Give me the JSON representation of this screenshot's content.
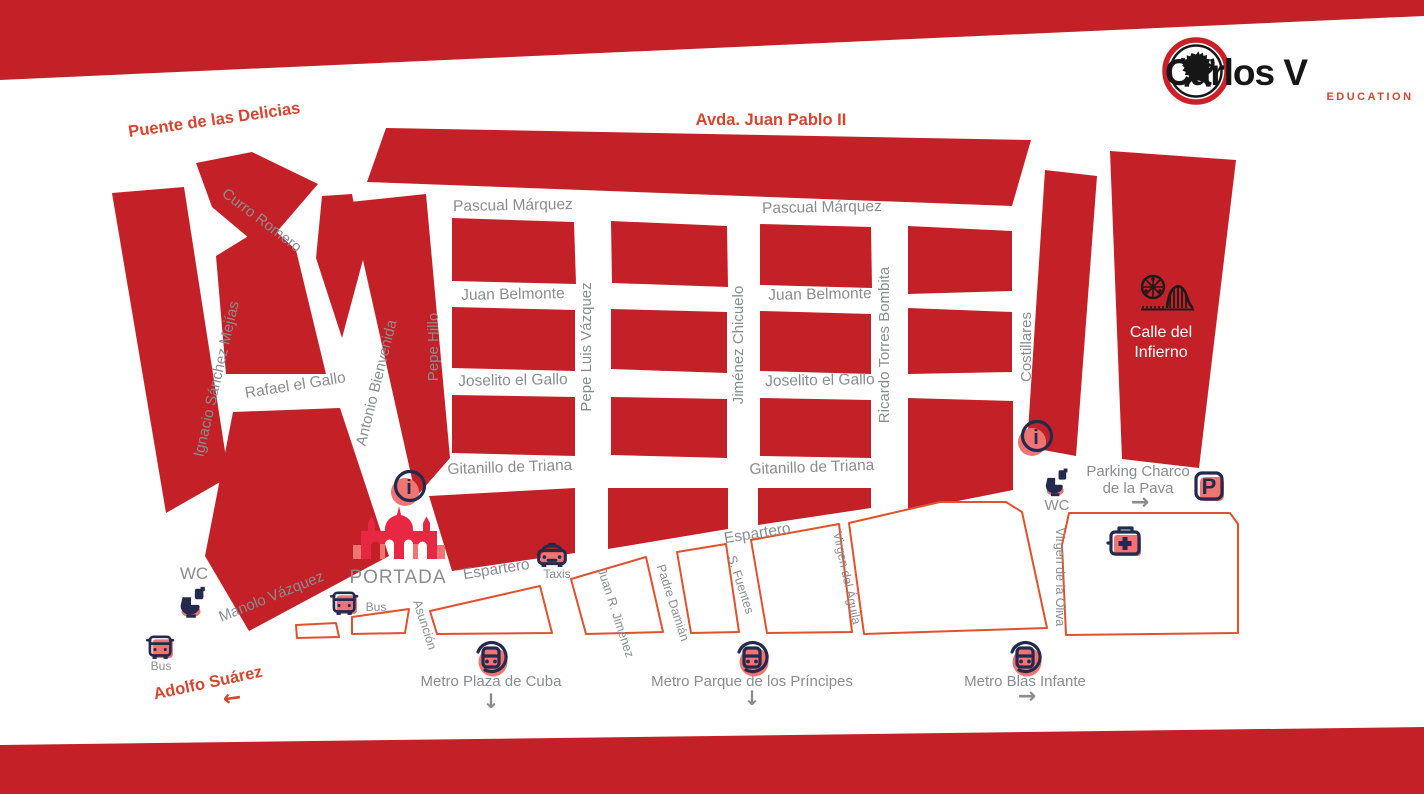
{
  "brand": {
    "name": "Carlos V",
    "tagline": "EDUCATION"
  },
  "icons": {
    "info_glyph": "i",
    "parking_glyph": "P"
  },
  "map": {
    "labels": [
      {
        "id": "puente-de-las-delicias",
        "text": "Puente de las Delicias",
        "x": 215,
        "y": 125,
        "rot": -8,
        "size": 16.5,
        "cls": "lbl-red"
      },
      {
        "id": "avda-juan-pablo-ii",
        "text": "Avda. Juan Pablo II",
        "x": 771,
        "y": 125,
        "rot": 0,
        "size": 16.5,
        "cls": "lbl-red"
      },
      {
        "id": "adolfo-suarez",
        "text": "Adolfo Suárez",
        "x": 209,
        "y": 688,
        "rot": -12,
        "size": 16.5,
        "cls": "lbl-red"
      },
      {
        "id": "adolfo-arrow",
        "text": "←",
        "x": 233,
        "y": 705,
        "rot": -8,
        "size": 22,
        "cls": "lbl-arrow-red"
      },
      {
        "id": "curro-romero",
        "text": "Curro Romero",
        "x": 259,
        "y": 224,
        "rot": 37,
        "size": 15
      },
      {
        "id": "ignacio-sanchez-mejias",
        "text": "Ignacio Sánchez Mejías",
        "x": 221,
        "y": 380,
        "rot": -77,
        "size": 15
      },
      {
        "id": "rafael-el-gallo",
        "text": "Rafael el Gallo",
        "x": 296,
        "y": 390,
        "rot": -9,
        "size": 15.5
      },
      {
        "id": "antonio-bienvenida",
        "text": "Antonio Bienvenida",
        "x": 381,
        "y": 384,
        "rot": -76,
        "size": 15
      },
      {
        "id": "pepe-hillo",
        "text": "Pepe Hillo",
        "x": 438,
        "y": 347,
        "rot": -90,
        "size": 15
      },
      {
        "id": "pascual-marquez-1",
        "text": "Pascual Márquez",
        "x": 513,
        "y": 210,
        "rot": -1,
        "size": 15.5
      },
      {
        "id": "pascual-marquez-2",
        "text": "Pascual Márquez",
        "x": 822,
        "y": 212,
        "rot": -1,
        "size": 15.5
      },
      {
        "id": "juan-belmonte-1",
        "text": "Juan Belmonte",
        "x": 513,
        "y": 299,
        "rot": -1,
        "size": 15.5
      },
      {
        "id": "juan-belmonte-2",
        "text": "Juan Belmonte",
        "x": 820,
        "y": 299,
        "rot": -1,
        "size": 15.5
      },
      {
        "id": "joselito-el-gallo-1",
        "text": "Joselito el Gallo",
        "x": 513,
        "y": 385,
        "rot": -1,
        "size": 15.5
      },
      {
        "id": "joselito-el-gallo-2",
        "text": "Joselito el Gallo",
        "x": 820,
        "y": 385,
        "rot": -1,
        "size": 15.5
      },
      {
        "id": "pepe-luis-vazquez",
        "text": "Pepe Luis Vázquez",
        "x": 591,
        "y": 347,
        "rot": -90,
        "size": 15
      },
      {
        "id": "jimenez-chicuelo",
        "text": "Jiménez Chicuelo",
        "x": 743,
        "y": 345,
        "rot": -90,
        "size": 15
      },
      {
        "id": "ricardo-torres-bombita",
        "text": "Ricardo Torres Bombita",
        "x": 889,
        "y": 345,
        "rot": -90,
        "size": 15
      },
      {
        "id": "gitanillo-de-triana-1",
        "text": "Gitanillo de Triana",
        "x": 510,
        "y": 472,
        "rot": -2,
        "size": 15.5
      },
      {
        "id": "gitanillo-de-triana-2",
        "text": "Gitanillo de Triana",
        "x": 812,
        "y": 472,
        "rot": -2,
        "size": 15.5
      },
      {
        "id": "costillares",
        "text": "Costillares",
        "x": 1031,
        "y": 347,
        "rot": -90,
        "size": 15
      },
      {
        "id": "espartero-1",
        "text": "Espartero",
        "x": 497,
        "y": 574,
        "rot": -9,
        "size": 15.5
      },
      {
        "id": "espartero-2",
        "text": "Espartero",
        "x": 758,
        "y": 538,
        "rot": -9,
        "size": 15.5
      },
      {
        "id": "manolo-vazquez",
        "text": "Manolo Vázquez",
        "x": 273,
        "y": 601,
        "rot": -22,
        "size": 15
      },
      {
        "id": "asuncion",
        "text": "Asunción",
        "x": 421,
        "y": 626,
        "rot": 72,
        "size": 12.5
      },
      {
        "id": "juan-r-jimenez",
        "text": "Juan R. Jiménez",
        "x": 612,
        "y": 614,
        "rot": 72,
        "size": 12.5
      },
      {
        "id": "padre-damian",
        "text": "Padre Damián",
        "x": 669,
        "y": 604,
        "rot": 72,
        "size": 12.5
      },
      {
        "id": "s-fuentes",
        "text": "S. Fuentes",
        "x": 737,
        "y": 586,
        "rot": 72,
        "size": 12.5
      },
      {
        "id": "virgen-del-aguila",
        "text": "Virgen del Águila",
        "x": 843,
        "y": 579,
        "rot": 78,
        "size": 12.5
      },
      {
        "id": "virgen-de-la-oliva",
        "text": "Virgen de la Oliva",
        "x": 1056,
        "y": 577,
        "rot": 90,
        "size": 12.5
      },
      {
        "id": "portada",
        "text": "PORTADA",
        "x": 398,
        "y": 583,
        "rot": 0,
        "size": 19,
        "ls": 1
      },
      {
        "id": "wc-1",
        "text": "WC",
        "x": 194,
        "y": 579,
        "rot": 0,
        "size": 17
      },
      {
        "id": "wc-2",
        "text": "WC",
        "x": 1057,
        "y": 510,
        "rot": 0,
        "size": 15
      },
      {
        "id": "bus-1",
        "text": "Bus",
        "x": 161,
        "y": 670,
        "rot": 0,
        "size": 12
      },
      {
        "id": "bus-2",
        "text": "Bus",
        "x": 376,
        "y": 611,
        "rot": 0,
        "size": 12
      },
      {
        "id": "taxis",
        "text": "Taxis",
        "x": 557,
        "y": 578,
        "rot": 0,
        "size": 12
      },
      {
        "id": "parking-charco-1",
        "text": "Parking Charco",
        "x": 1138,
        "y": 476,
        "rot": 0,
        "size": 15
      },
      {
        "id": "parking-charco-2",
        "text": "de la Pava",
        "x": 1138,
        "y": 493,
        "rot": 0,
        "size": 15
      },
      {
        "id": "parking-arrow",
        "text": "→",
        "x": 1140,
        "y": 509,
        "rot": 0,
        "size": 22,
        "cls": "lbl-arrow"
      },
      {
        "id": "metro-plaza-de-cuba",
        "text": "Metro Plaza de Cuba",
        "x": 491,
        "y": 686,
        "rot": 0,
        "size": 15
      },
      {
        "id": "metro-plaza-arrow",
        "text": "↓",
        "x": 491,
        "y": 708,
        "rot": 0,
        "size": 20,
        "cls": "lbl-arrow"
      },
      {
        "id": "metro-parque-principes",
        "text": "Metro Parque de los Príncipes",
        "x": 752,
        "y": 686,
        "rot": 0,
        "size": 15
      },
      {
        "id": "metro-parque-arrow",
        "text": "↓",
        "x": 752,
        "y": 705,
        "rot": 0,
        "size": 20,
        "cls": "lbl-arrow"
      },
      {
        "id": "metro-blas-infante",
        "text": "Metro Blas Infante",
        "x": 1025,
        "y": 686,
        "rot": 0,
        "size": 15
      },
      {
        "id": "metro-blas-arrow",
        "text": "→",
        "x": 1027,
        "y": 703,
        "rot": 0,
        "size": 22,
        "cls": "lbl-arrow"
      },
      {
        "id": "calle-infierno-1",
        "text": "Calle del",
        "x": 1161,
        "y": 337,
        "rot": 0,
        "size": 16,
        "cls": "lbl-white"
      },
      {
        "id": "calle-infierno-2",
        "text": "Infierno",
        "x": 1161,
        "y": 357,
        "rot": 0,
        "size": 16,
        "cls": "lbl-white"
      }
    ]
  }
}
